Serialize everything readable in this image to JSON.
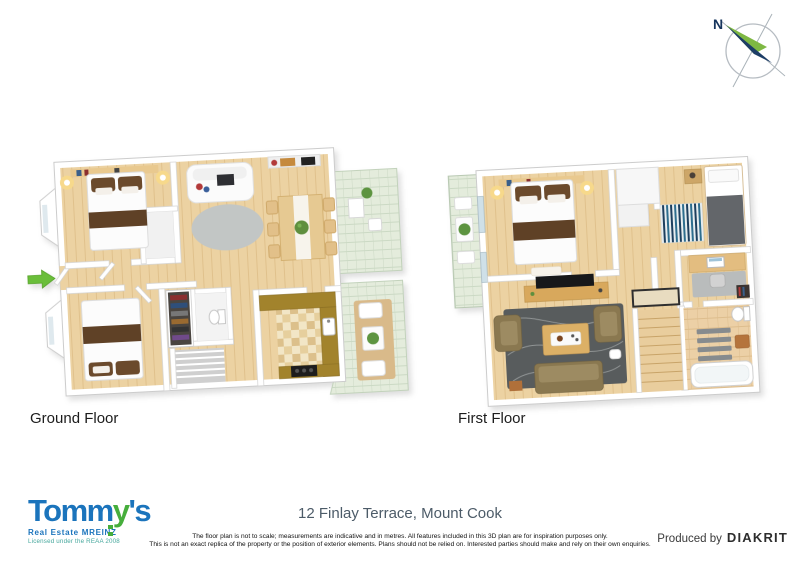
{
  "compass": {
    "north_label": "N"
  },
  "plans": {
    "ground": {
      "label": "Ground Floor"
    },
    "first": {
      "label": "First Floor"
    }
  },
  "footer": {
    "address": "12 Finlay Terrace, Mount Cook",
    "disclaimer_line1": "The floor plan is not to scale; measurements are indicative and in metres. All features included in this 3D plan are for inspiration purposes only.",
    "disclaimer_line2": "This is not an exact replica of the property or the position of exterior elements. Plans should not be relied on. Interested parties should make and rely on their own enquiries.",
    "produced_by_label": "Produced by",
    "producer_name": "DIAKRIT",
    "logo": {
      "brand_prefix": "Tomm",
      "brand_key_letter": "y",
      "brand_suffix": "'s",
      "tagline": "Real Estate MREINZ",
      "licence": "Licensed under the REAA 2008"
    }
  },
  "icons": {
    "compass": "compass-rose",
    "entrance_arrow": "green-right-arrow"
  },
  "colors": {
    "brand_blue": "#1b74bc",
    "brand_green": "#46ae3c",
    "compass_navy": "#16355d",
    "compass_green": "#7eb843",
    "entrance_arrow_green": "#6abe3a",
    "wood_floor": "#ecd2a2",
    "terrace_tile_green": "#e4ecdc",
    "kitchen_counter_olive": "#a2832c",
    "address_text": "#4c5b68"
  }
}
